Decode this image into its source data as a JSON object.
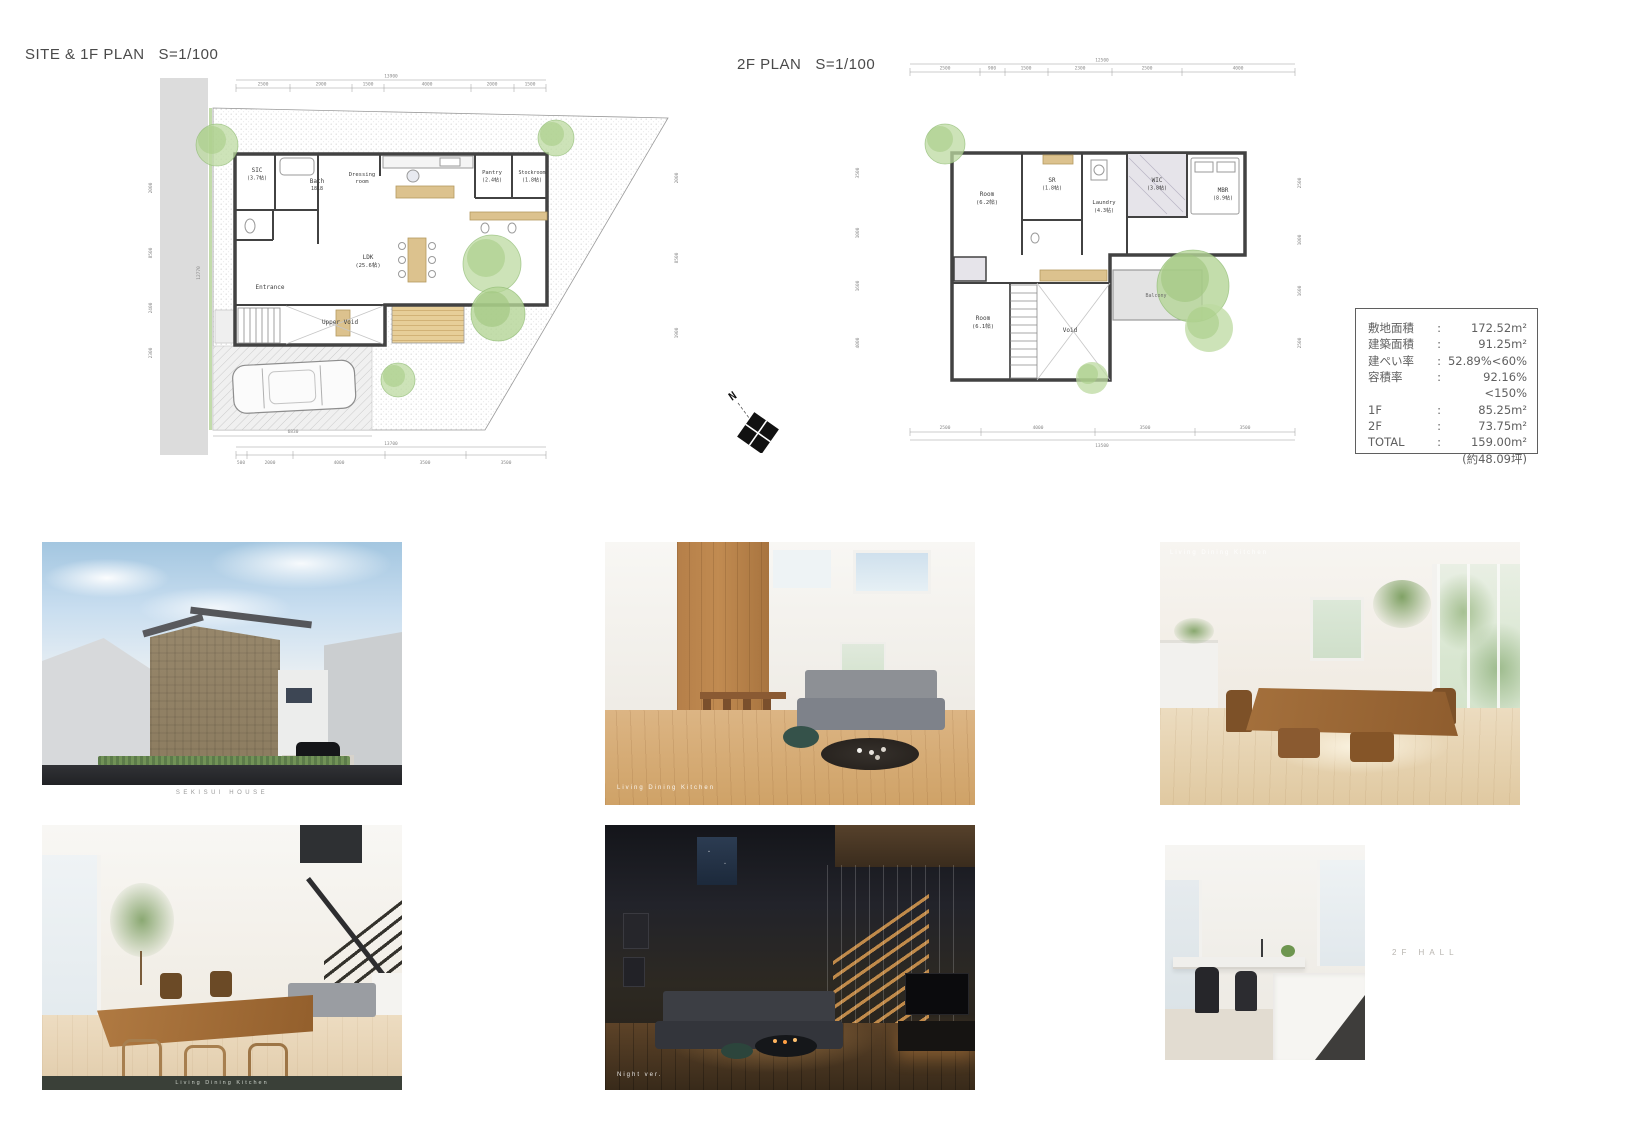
{
  "titles": {
    "plan1f": "SITE & 1F PLAN   S=1/100",
    "plan2f": "2F PLAN   S=1/100"
  },
  "north": {
    "label": "N"
  },
  "plan1f": {
    "rooms": {
      "sic": {
        "name": "SIC",
        "size": "(3.7帖)"
      },
      "bath": {
        "name": "Bath",
        "size": "1818"
      },
      "dressing": {
        "line1": "Dressing",
        "line2": "room"
      },
      "pantry": {
        "name": "Pantry",
        "size": "(2.4帖)"
      },
      "stockroom": {
        "name": "Stockroom",
        "size": "(1.8帖)"
      },
      "ldk": {
        "name": "LDK",
        "size": "(25.6帖)"
      },
      "entrance": {
        "name": "Entrance"
      },
      "upper_void": {
        "name": "Upper Void"
      }
    },
    "dims": {
      "top_total": "13900",
      "top": [
        "2500",
        "2900",
        "1500",
        "4000",
        "2000",
        "1500"
      ],
      "bottom_total": "13700",
      "bottom": [
        "500",
        "2000",
        "4000",
        "3500",
        "3500"
      ],
      "deck_width": "6830",
      "left": [
        "2000",
        "8500",
        "2400",
        "2300"
      ],
      "right": [
        "2000",
        "8500",
        "1900"
      ],
      "road": "12770"
    }
  },
  "plan2f": {
    "rooms": {
      "room_a": {
        "name": "Room",
        "size": "(6.2帖)"
      },
      "sr": {
        "name": "SR",
        "size": "(1.8帖)"
      },
      "laundry": {
        "name": "Laundry",
        "size": "(4.3帖)"
      },
      "wic": {
        "name": "WIC",
        "size": "(3.8帖)"
      },
      "mbr": {
        "name": "MBR",
        "size": "(8.9帖)"
      },
      "room_b": {
        "name": "Room",
        "size": "(6.1帖)"
      },
      "void": {
        "name": "Void"
      },
      "balcony": {
        "name": "Balcony"
      }
    },
    "dims": {
      "top_total": "12500",
      "top": [
        "2500",
        "900",
        "1500",
        "2300",
        "2500",
        "4000"
      ],
      "bottom_total": "13500",
      "bottom": [
        "2500",
        "4000",
        "3500",
        "3500"
      ],
      "left": [
        "3500",
        "1000",
        "1600",
        "4000"
      ],
      "right": [
        "2500",
        "1000",
        "1600",
        "2500"
      ]
    }
  },
  "area_table": {
    "rows": [
      {
        "label": "敷地面積",
        "sep": ":",
        "value": "172.52m²"
      },
      {
        "label": "建築面積",
        "sep": ":",
        "value": "91.25m²"
      },
      {
        "label": "建ぺい率",
        "sep": ":",
        "value": "52.89%<60%"
      },
      {
        "label": "容積率",
        "sep": ":",
        "value": "92.16%<150%"
      },
      {
        "label": "1F",
        "sep": ":",
        "value": "85.25m²"
      },
      {
        "label": "2F",
        "sep": ":",
        "value": "73.75m²"
      },
      {
        "label": "TOTAL",
        "sep": ":",
        "value": "159.00m²"
      }
    ],
    "note": "(約48.09坪)"
  },
  "renders": {
    "exterior": {
      "caption": "SEKISUI HOUSE"
    },
    "ldk": {
      "caption": "Living Dining Kitchen"
    },
    "dining": {
      "caption": "Living Dining Kitchen"
    },
    "dining2": {
      "caption": "Living Dining Kitchen"
    },
    "night": {
      "caption": "Night ver."
    },
    "hall": {
      "label": "2F HALL"
    }
  }
}
